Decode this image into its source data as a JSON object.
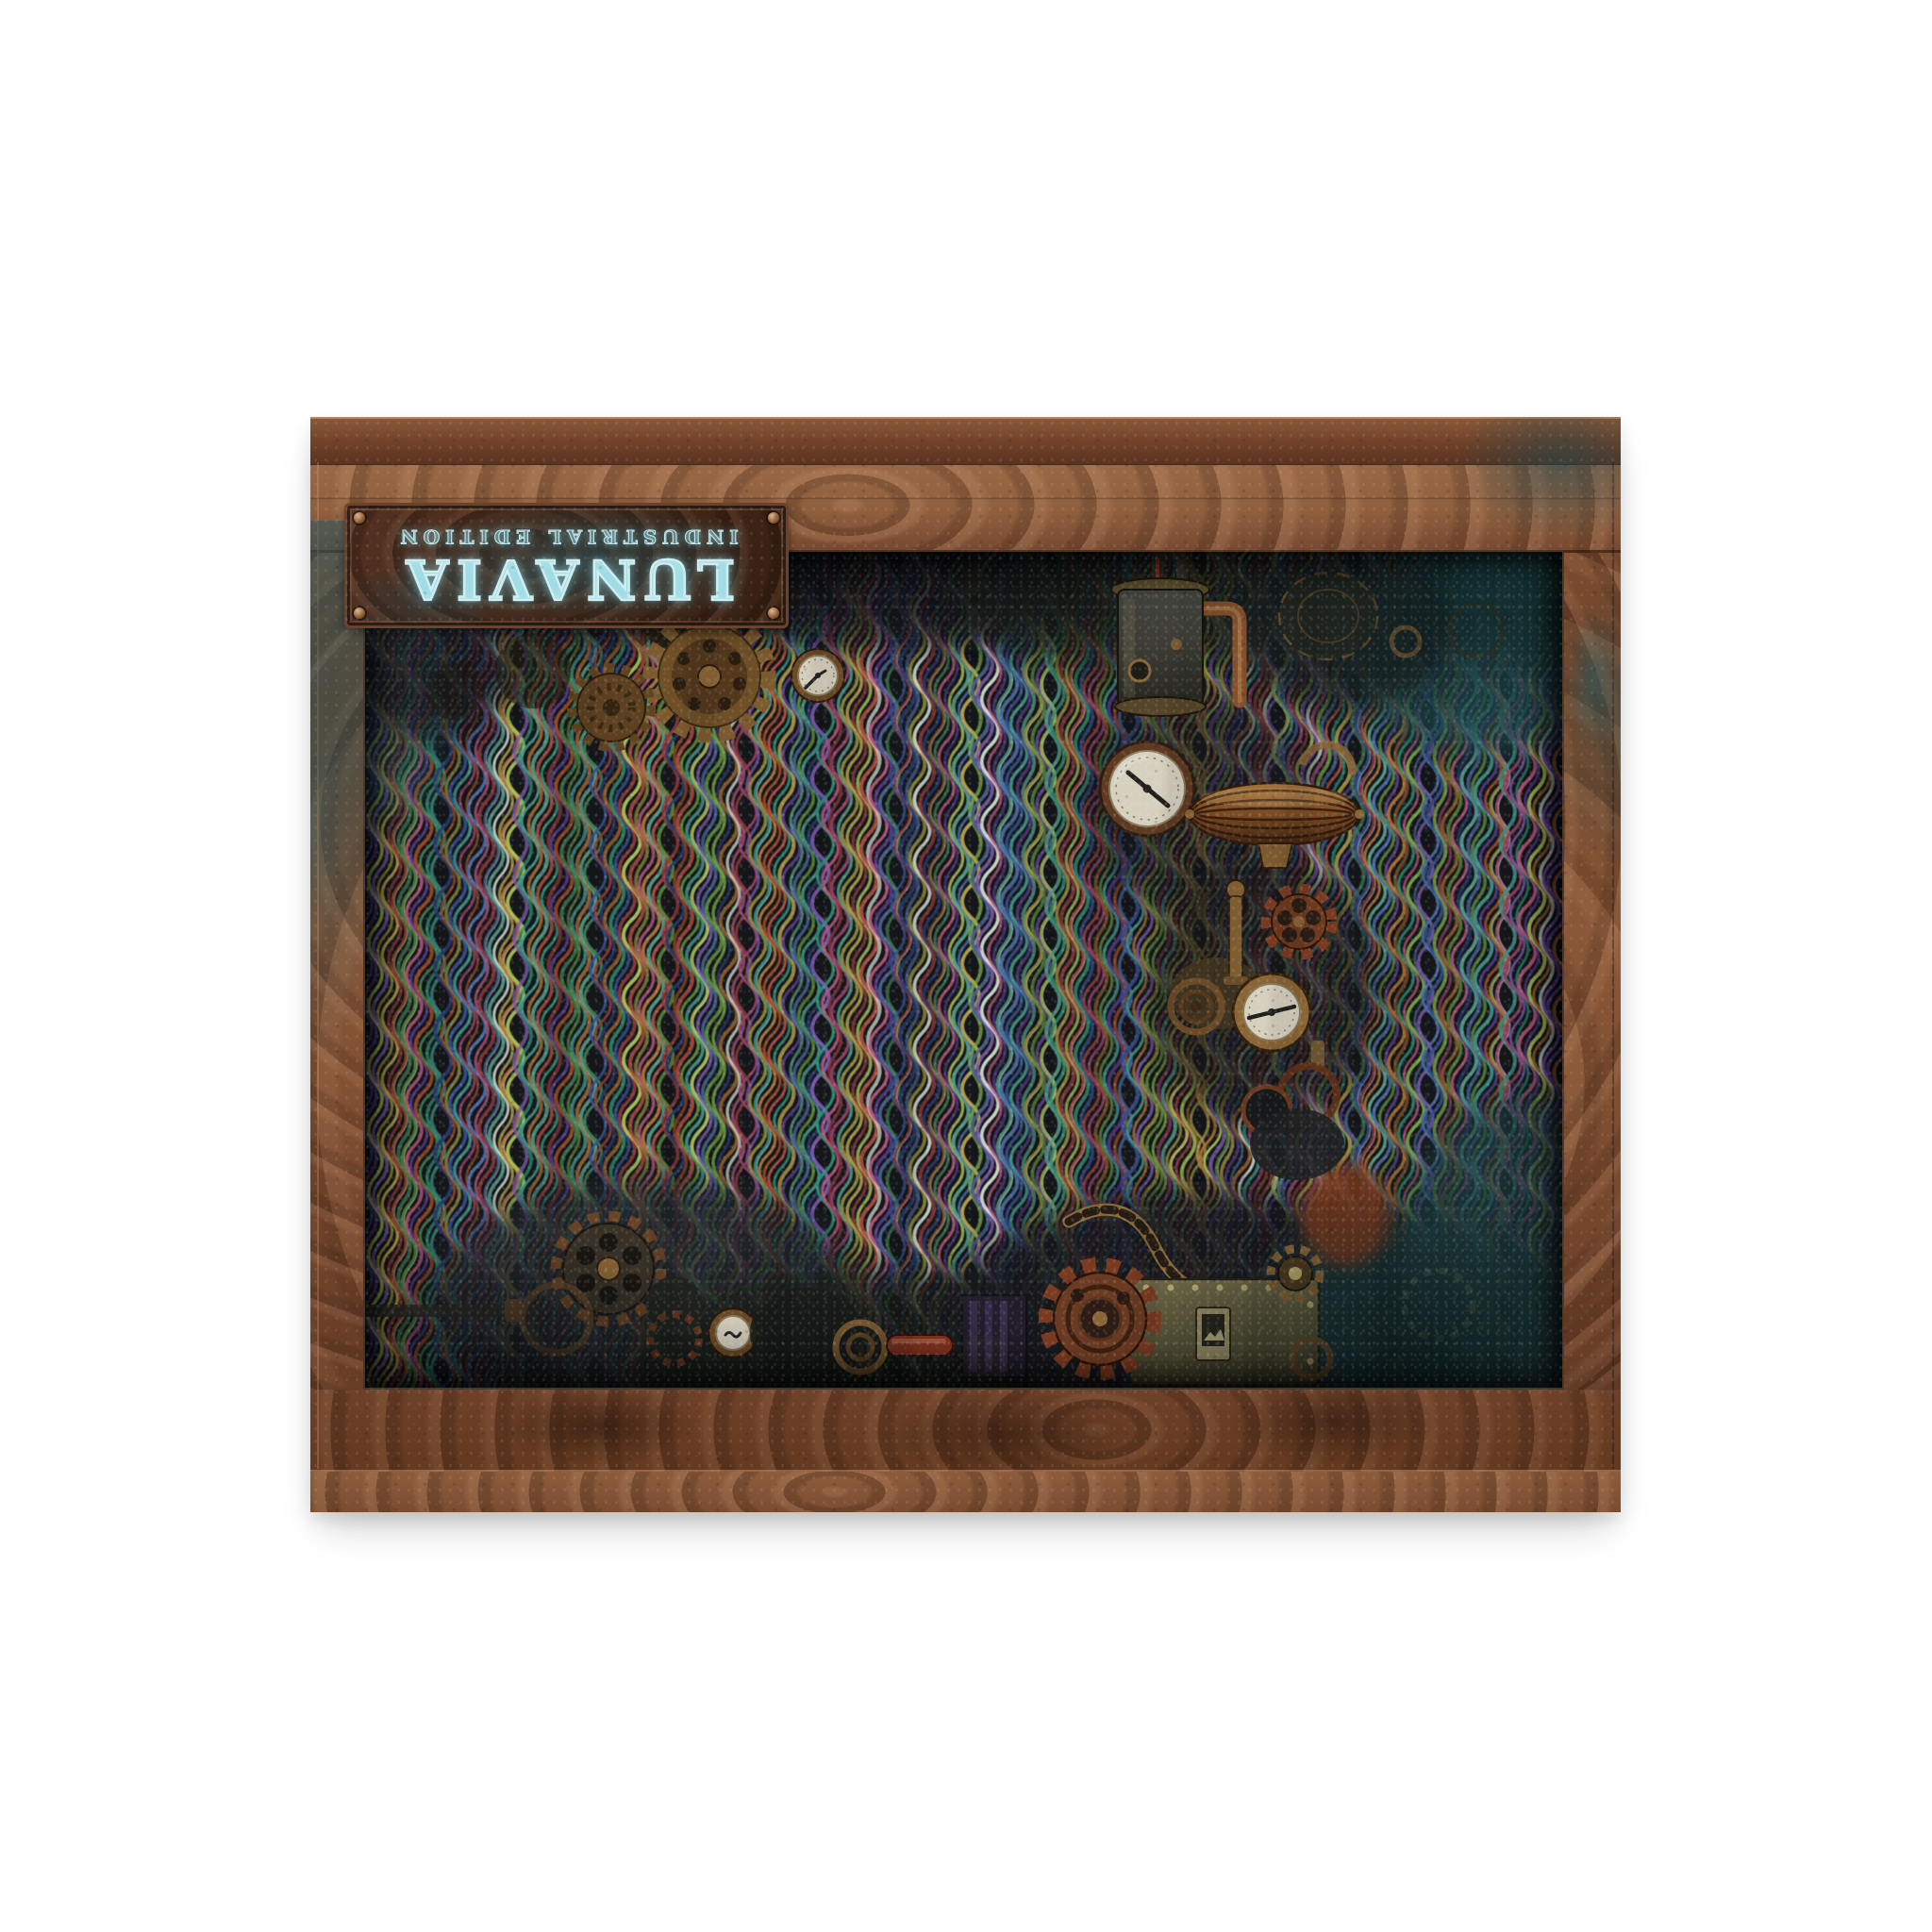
{
  "product": {
    "name": "LUNAVIA",
    "edition": "INDUSTRIAL EDITION"
  },
  "colors": {
    "page_background": "#ffffff",
    "frame_copper_light": "#9a6845",
    "frame_copper_dark": "#5e3824",
    "patina_teal": "#2e6066",
    "plate_face": "#2c464a",
    "title_glow": "#cdeef3",
    "interior_background": "#141619",
    "gauge_face": "#d6d0bf",
    "rust": "#7a3a20",
    "brass": "#8a6535",
    "stripe_palette": [
      "#5d8c3c",
      "#36508f",
      "#b05578",
      "#b5a04a",
      "#6a4a9a",
      "#3f8f84",
      "#8f3a3c",
      "#7fae4a",
      "#523a85",
      "#b07438",
      "#2a3a6e",
      "#8f3f62",
      "#a9bf55",
      "#49628c",
      "#9a4a28",
      "#57a08c",
      "#7a5aa8",
      "#8a5a2c",
      "#b04e42",
      "#3f7a50",
      "#4a6aa0",
      "#8f8a3a",
      "#2f8f72",
      "#cfd8cc"
    ]
  }
}
